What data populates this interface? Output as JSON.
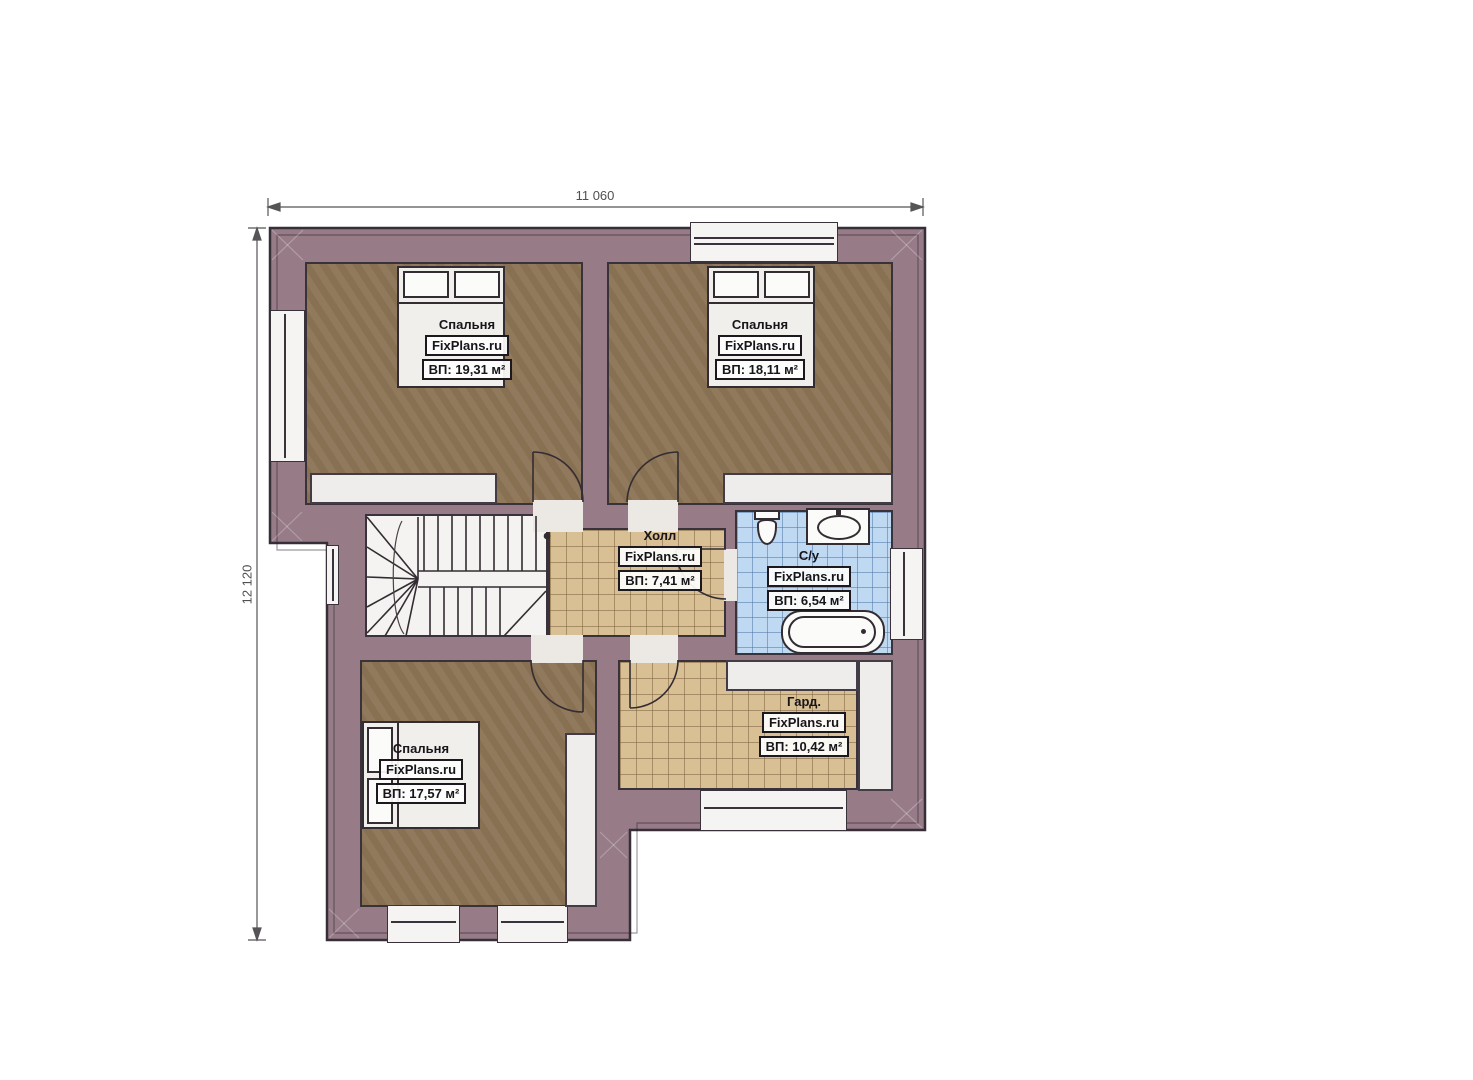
{
  "dimensions": {
    "width_label": "11 060",
    "height_label": "12 120"
  },
  "rooms": {
    "bedroom1": {
      "name": "Спальня",
      "brand": "FixPlans.ru",
      "area": "ВП: 19,31 м²"
    },
    "bedroom2": {
      "name": "Спальня",
      "brand": "FixPlans.ru",
      "area": "ВП: 18,11 м²"
    },
    "bedroom3": {
      "name": "Спальня",
      "brand": "FixPlans.ru",
      "area": "ВП: 17,57 м²"
    },
    "hall": {
      "name": "Холл",
      "brand": "FixPlans.ru",
      "area": "ВП: 7,41 м²"
    },
    "bathroom": {
      "name": "С/у",
      "brand": "FixPlans.ru",
      "area": "ВП: 6,54 м²"
    },
    "wardrobe": {
      "name": "Гард.",
      "brand": "FixPlans.ru",
      "area": "ВП: 10,42 м²"
    }
  },
  "colors": {
    "wall": "#977c88",
    "outline": "#372f38",
    "bedroom_floor": "#8d7456",
    "tile_floor": "#d9bf94",
    "bathroom_floor": "#bfd9f2",
    "fixture_white": "#f1efec"
  }
}
